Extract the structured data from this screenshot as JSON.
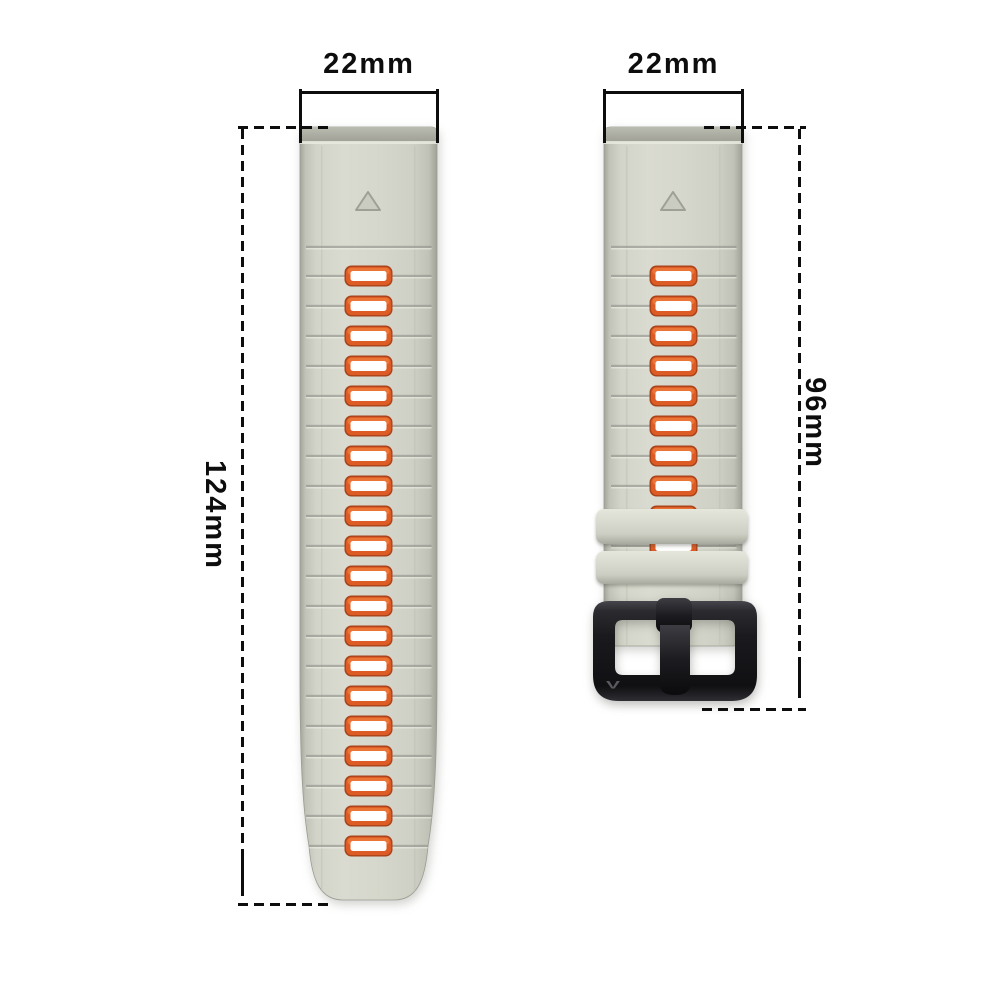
{
  "figure": {
    "description": "Watch band dimension diagram, two silicone strap halves with measurement annotations",
    "background": "#ffffff"
  },
  "measurements": {
    "left_strap_width": "22mm",
    "right_strap_width": "22mm",
    "left_strap_length": "124mm",
    "right_strap_length": "96mm"
  },
  "straps": {
    "left": {
      "name": "long-tail-strap",
      "hole_count": 20,
      "marker": "triangle"
    },
    "right": {
      "name": "buckle-strap",
      "visible_hole_count": 10,
      "keeper_count": 2,
      "marker": "triangle",
      "buckle_logo": "V"
    }
  },
  "colors": {
    "background": "#ffffff",
    "line_color": "#0d0d0d",
    "strap_mid": "#d7d8cd",
    "strap_edge": "#a6a79c",
    "groove": "#90918a",
    "hole_rim": "#dd5c26",
    "hole_rim_dark": "#a8431a",
    "hole_fill": "#ffffff",
    "keeper": "#d6d7cc",
    "buckle_dark": "#141417"
  }
}
